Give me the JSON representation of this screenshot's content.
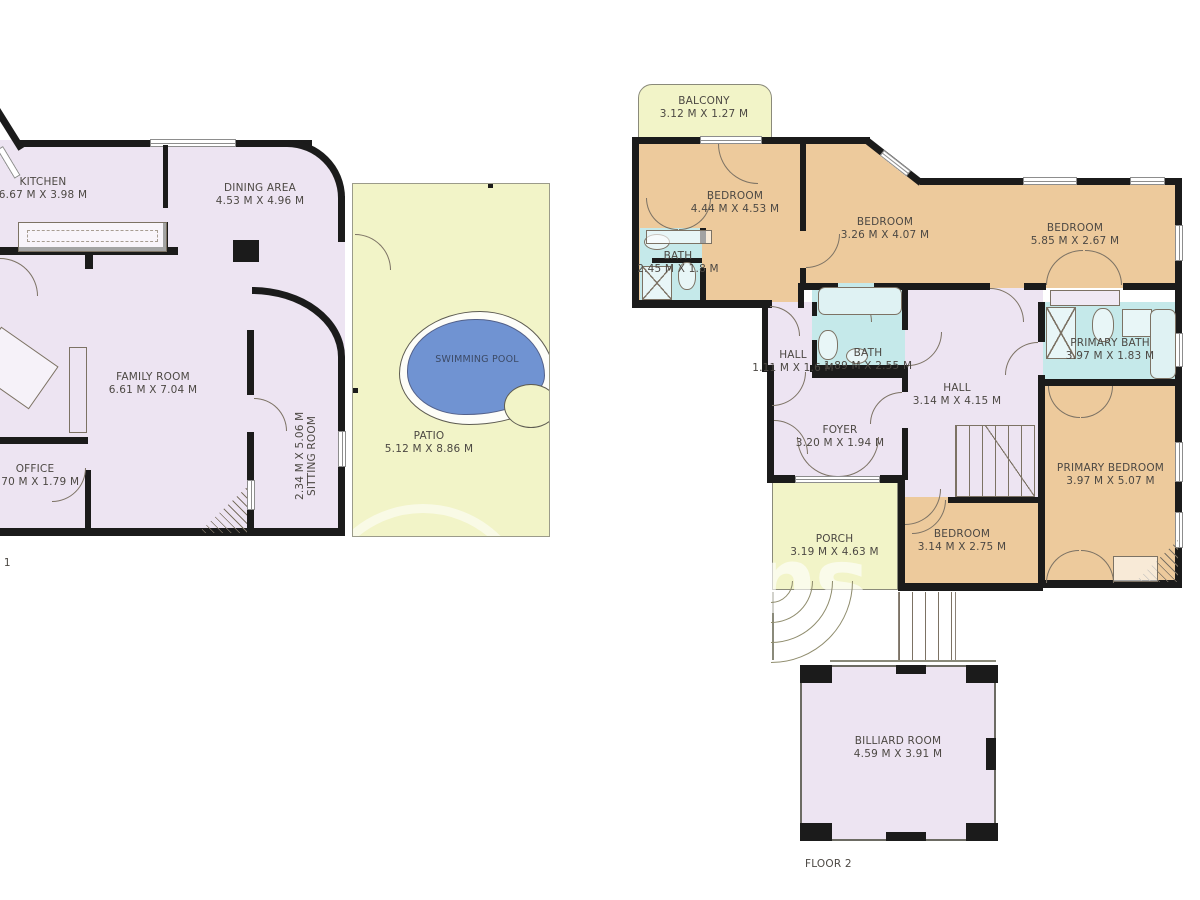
{
  "palette": {
    "wall": "#1b1b1b",
    "interior_lavender": "#ede4f2",
    "bedroom_tan": "#edca9c",
    "bath_cyan": "#c5e9ea",
    "outdoor_yellow": "#f2f4c8",
    "pool_blue": "#7093d2"
  },
  "watermark": {
    "letters": "ns"
  },
  "floor1": {
    "label": "FLOOR 1",
    "rooms": {
      "kitchen": {
        "name": "KITCHEN",
        "dims": "6.67 M X 3.98 M"
      },
      "dining": {
        "name": "DINING AREA",
        "dims": "4.53 M X 4.96 M"
      },
      "family": {
        "name": "FAMILY ROOM",
        "dims": "6.61 M X 7.04 M"
      },
      "office": {
        "name": "OFFICE",
        "dims": "2.70 M X 1.79 M"
      },
      "sitting": {
        "name": "SITTING ROOM",
        "dims": "2.34 M X 5.06 M"
      },
      "patio": {
        "name": "PATIO",
        "dims": "5.12 M X 8.86 M"
      },
      "pool": {
        "name": "SWIMMING POOL"
      }
    }
  },
  "floor2": {
    "label": "FLOOR 2",
    "rooms": {
      "balcony": {
        "name": "BALCONY",
        "dims": "3.12 M X 1.27 M"
      },
      "bedroom_nw": {
        "name": "BEDROOM",
        "dims": "4.44 M X 4.53 M"
      },
      "bedroom_n": {
        "name": "BEDROOM",
        "dims": "3.26 M X 4.07 M"
      },
      "bedroom_ne": {
        "name": "BEDROOM",
        "dims": "5.85 M X 2.67 M"
      },
      "bath_nw": {
        "name": "BATH",
        "dims": "2.45 M X 1.8 M"
      },
      "hall_w": {
        "name": "HALL",
        "dims": "1.11 M X 1.6 M"
      },
      "bath_m": {
        "name": "BATH",
        "dims": "1.89 M X 2.55 M"
      },
      "hall_c": {
        "name": "HALL",
        "dims": "3.14 M X 4.15 M"
      },
      "primary_bath": {
        "name": "PRIMARY BATH",
        "dims": "3.97 M X 1.83 M"
      },
      "primary_bedroom": {
        "name": "PRIMARY BEDROOM",
        "dims": "3.97 M X 5.07 M"
      },
      "foyer": {
        "name": "FOYER",
        "dims": "3.20 M X 1.94 M"
      },
      "bedroom_s": {
        "name": "BEDROOM",
        "dims": "3.14 M X 2.75 M"
      },
      "porch": {
        "name": "PORCH",
        "dims": "3.19 M X 4.63 M"
      },
      "billiard": {
        "name": "BILLIARD ROOM",
        "dims": "4.59 M X 3.91 M"
      }
    }
  }
}
